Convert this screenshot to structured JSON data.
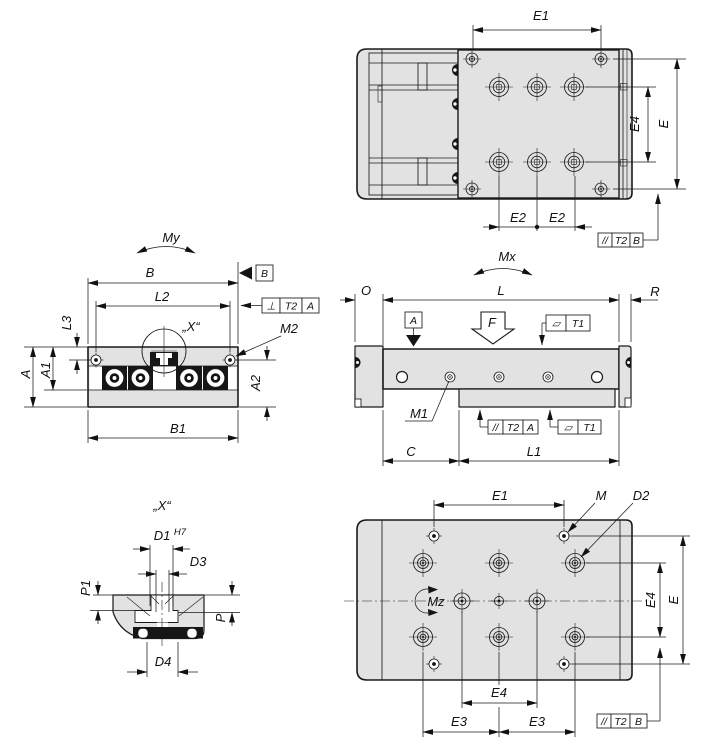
{
  "drawing": {
    "type": "engineering-dimension-drawing",
    "colors": {
      "body_fill": "#e2e2e2",
      "line": "#1a1a1a",
      "dark_fill": "#161616",
      "background": "#ffffff"
    },
    "labels": {
      "e": "E",
      "e1": "E1",
      "e2": "E2",
      "e3": "E3",
      "e4": "E4",
      "a": "A",
      "a1": "A1",
      "a2": "A2",
      "b": "B",
      "b1": "B1",
      "c": "C",
      "o": "O",
      "l": "L",
      "r": "R",
      "l1": "L1",
      "l2": "L2",
      "l3": "L3",
      "m": "M",
      "m1": "M1",
      "m2": "M2",
      "d1": "D1",
      "d1_fit": "H7",
      "d2": "D2",
      "d3": "D3",
      "d4": "D4",
      "p": "P",
      "p1": "P1",
      "f": "F",
      "mx": "Mx",
      "my": "My",
      "mz": "Mz",
      "detail": "„X“",
      "datum_a": "A",
      "datum_b": "B",
      "sym_parallelism": "//",
      "sym_perpendicularity": "⊥",
      "sym_flatness": "▱",
      "t1": "T1",
      "t2": "T2"
    }
  }
}
